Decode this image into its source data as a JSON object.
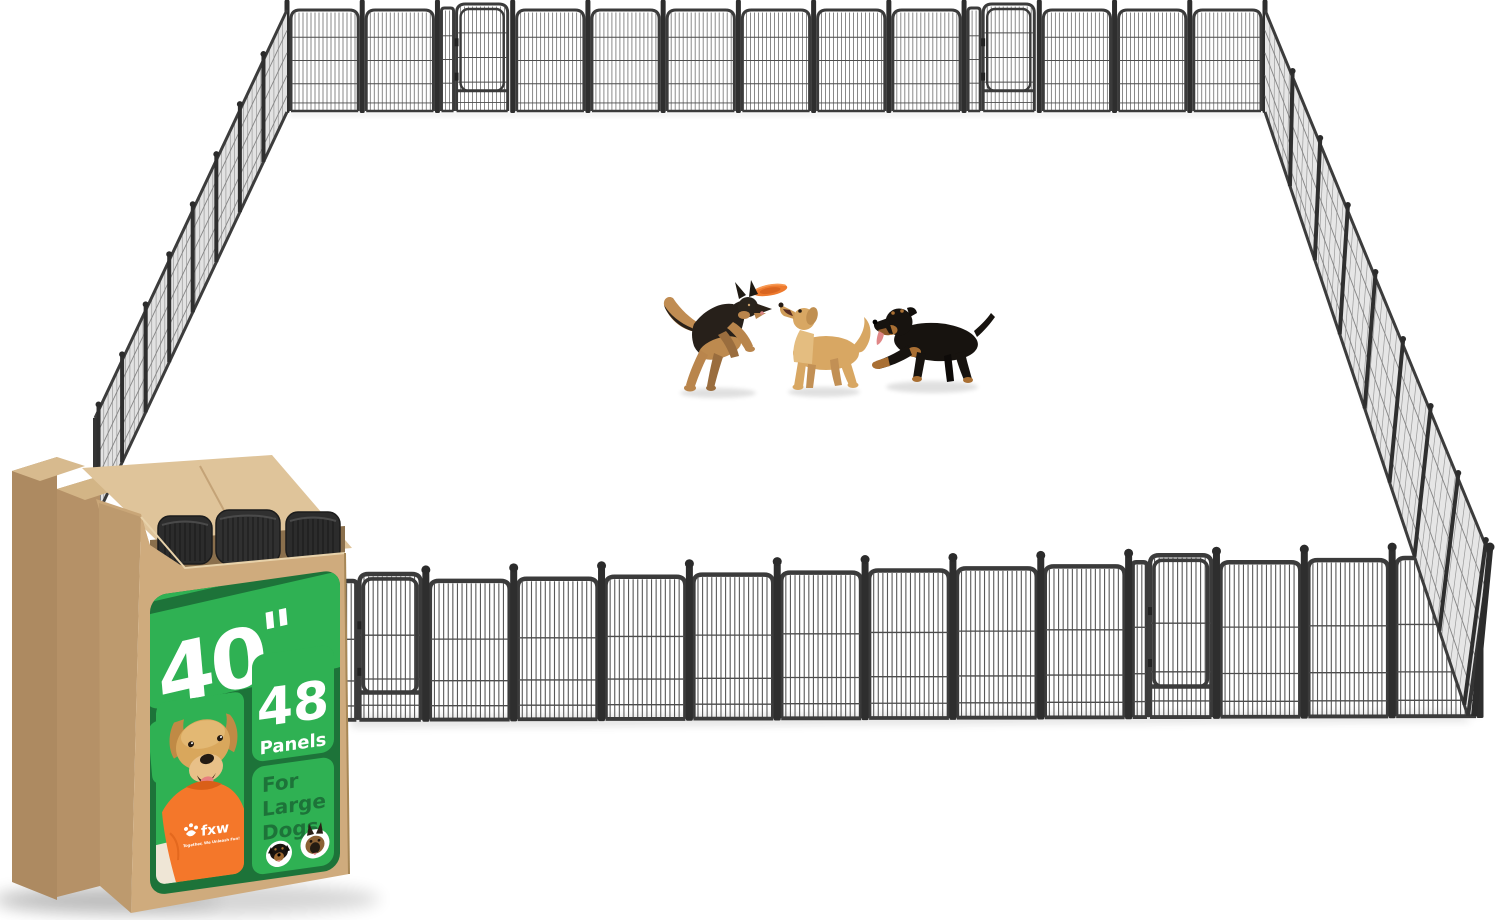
{
  "product": {
    "badge": {
      "height_value": "40",
      "height_quote": "\"",
      "height_unit": "tall",
      "count_value": "48",
      "count_unit": "Panels",
      "audience_line1": "For",
      "audience_line2": "Large",
      "audience_line3": "Dogs"
    },
    "brand": {
      "name": "fxw",
      "tagline": "Together, We Unleash Fun!"
    }
  },
  "scene": {
    "pen": {
      "shape": "rectangle",
      "walls": 4,
      "visible_gates": 4
    },
    "dogs": [
      {
        "breed": "German Shepherd"
      },
      {
        "breed": "Golden Retriever"
      },
      {
        "breed": "Rottweiler"
      }
    ],
    "toy": "orange frisbee"
  },
  "colors": {
    "label_green": "#2fb153",
    "label_dark_green": "#1d7339",
    "kraft_front": "#cfab7d",
    "kraft_side": "#b99469",
    "kraft_flap": "#dfc49a",
    "shirt_orange": "#f4772a",
    "frisbee_orange": "#ee7a2e",
    "fence_frame": "#3b3b3b",
    "background": "#ffffff"
  }
}
